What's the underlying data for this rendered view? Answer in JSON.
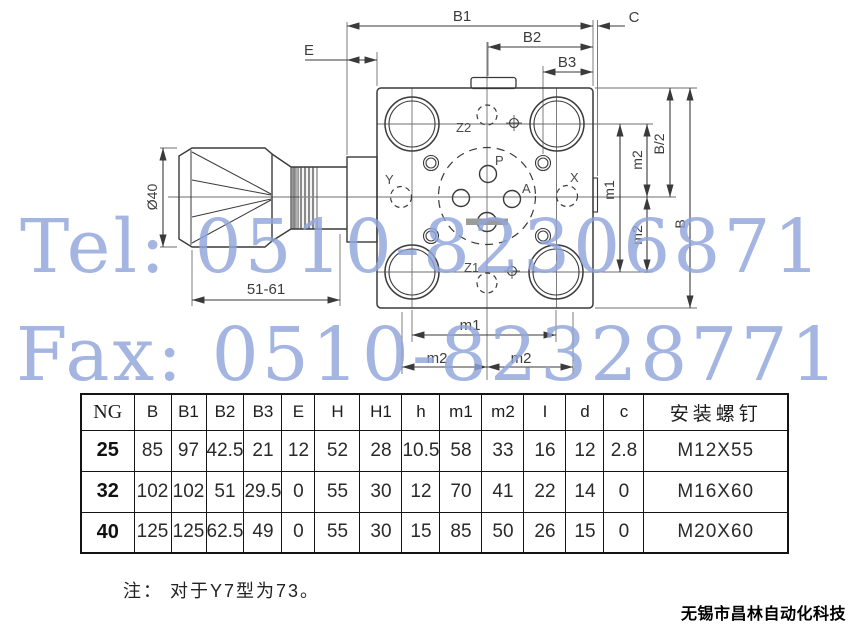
{
  "watermark": {
    "tel": "Tel: 0510-82306871",
    "fax": "Fax: 0510-82328771",
    "color": "#8fa5da"
  },
  "drawing": {
    "labels": {
      "b1": "B1",
      "b2": "B2",
      "b3": "B3",
      "c": "C",
      "e": "E",
      "dia": "Ø40",
      "range": "51-61",
      "m1": "m1",
      "m2": "m2",
      "b_half": "B/2",
      "b": "B"
    },
    "ports": {
      "z2": "Z2",
      "z1": "Z1",
      "p": "P",
      "a": "A",
      "x": "X",
      "y": "Y"
    }
  },
  "table": {
    "headers": [
      "NG",
      "B",
      "B1",
      "B2",
      "B3",
      "E",
      "H",
      "H1",
      "h",
      "m1",
      "m2",
      "I",
      "d",
      "c",
      "安装螺钉"
    ],
    "rows": [
      {
        "ng": "25",
        "values": [
          "85",
          "97",
          "42.5",
          "21",
          "12",
          "52",
          "28",
          "10.5",
          "58",
          "33",
          "16",
          "12",
          "2.8",
          "M12X55"
        ]
      },
      {
        "ng": "32",
        "values": [
          "102",
          "102",
          "51",
          "29.5",
          "0",
          "55",
          "30",
          "12",
          "70",
          "41",
          "22",
          "14",
          "0",
          "M16X60"
        ]
      },
      {
        "ng": "40",
        "values": [
          "125",
          "125",
          "62.5",
          "49",
          "0",
          "55",
          "30",
          "15",
          "85",
          "50",
          "26",
          "15",
          "0",
          "M20X60"
        ]
      }
    ]
  },
  "note": "注： 对于Y7型为73。",
  "company": "无锡市昌林自动化科技"
}
